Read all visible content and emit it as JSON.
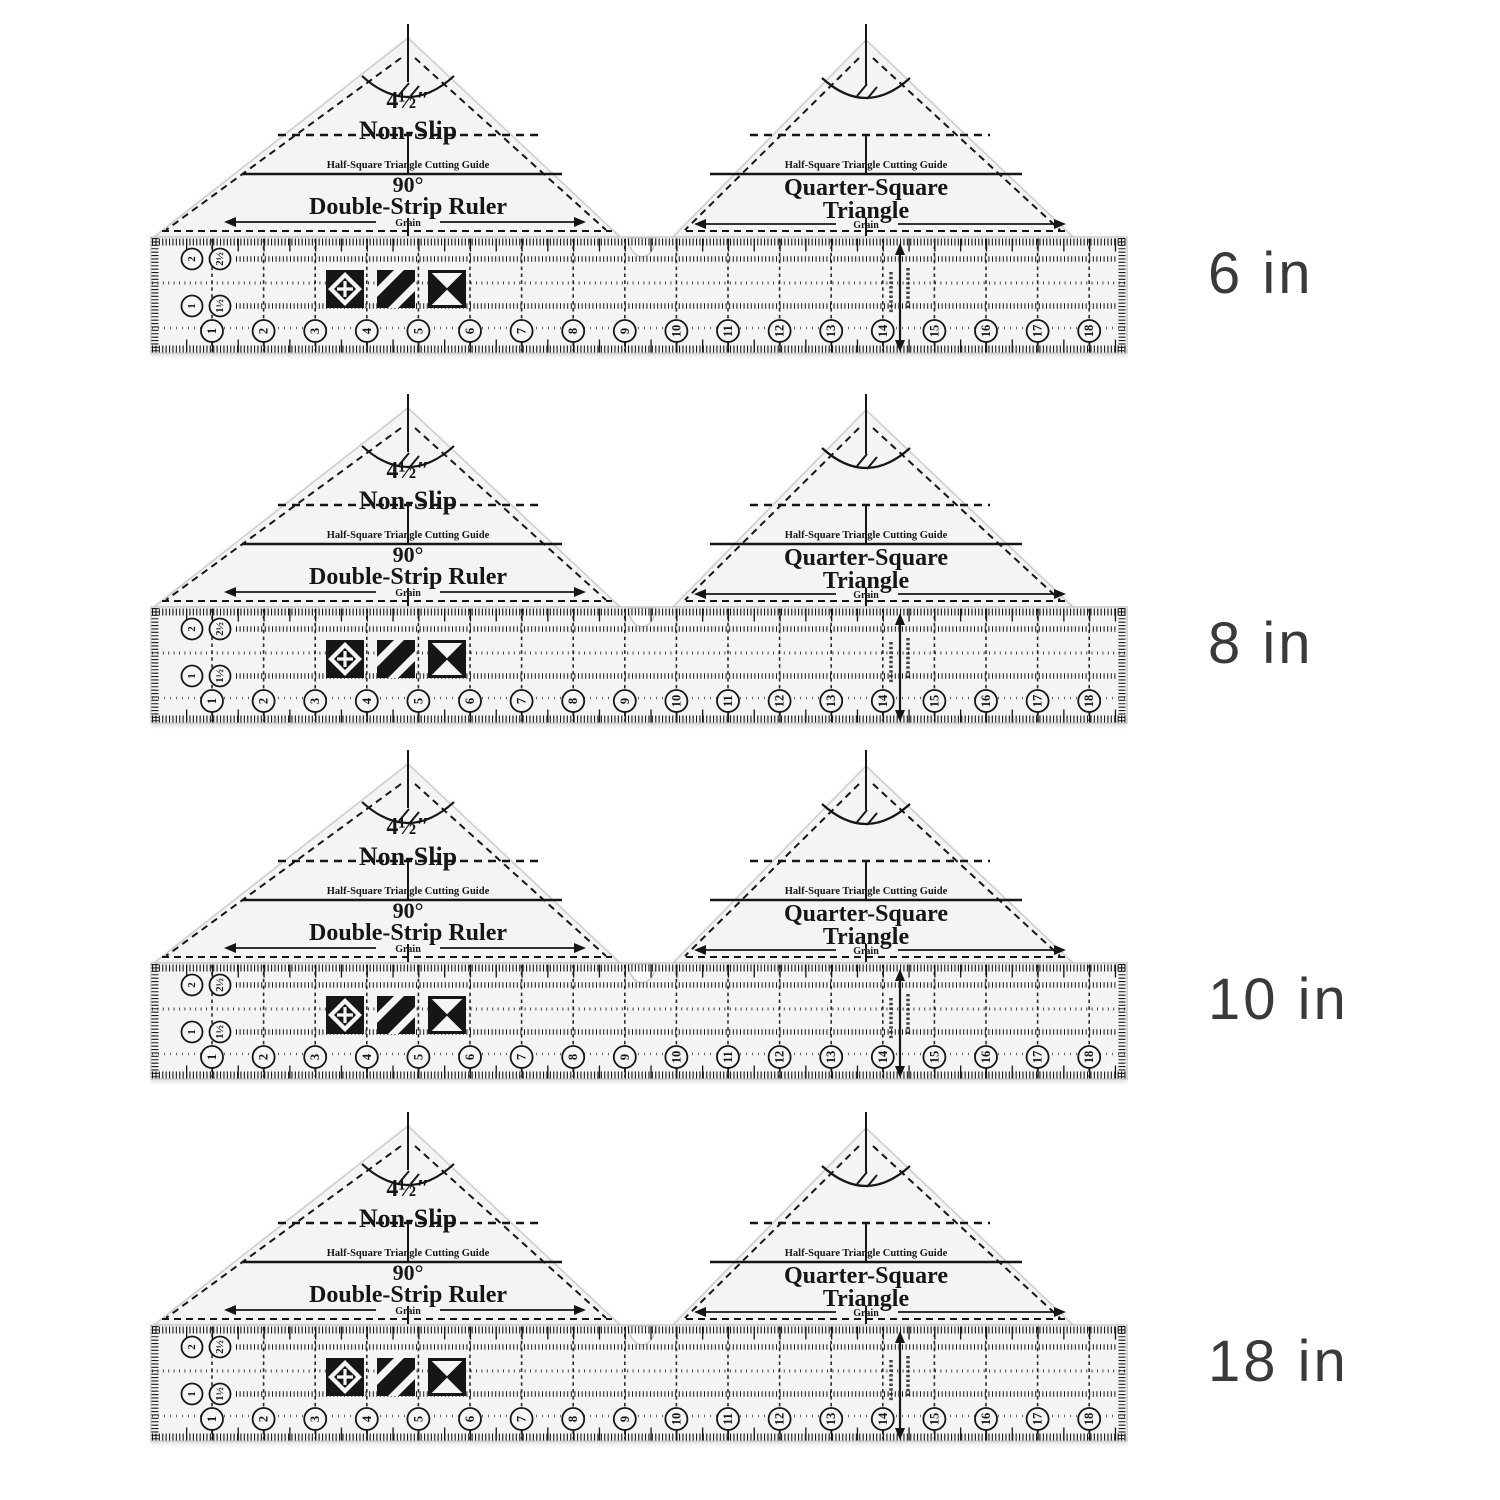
{
  "page": {
    "background": "#ffffff",
    "description_labels_unit": "in"
  },
  "rows": [
    {
      "size_label": "6 in"
    },
    {
      "size_label": "8 in"
    },
    {
      "size_label": "10 in"
    },
    {
      "size_label": "18 in"
    }
  ],
  "ruler": {
    "left_triangle": {
      "size": "4½″",
      "nonslip": "Non-Slip",
      "cutting_guide": "Half-Square Triangle Cutting Guide",
      "angle": "90°",
      "title": "Double-Strip Ruler",
      "grain": "Grain"
    },
    "right_triangle": {
      "cutting_guide": "Half-Square Triangle Cutting Guide",
      "title_line1": "Quarter-Square",
      "title_line2": "Triangle",
      "grain": "Grain"
    },
    "scale": {
      "inch_numbers": [
        "1",
        "2",
        "3",
        "4",
        "5",
        "6",
        "7",
        "8",
        "9",
        "10",
        "11",
        "12",
        "13",
        "14",
        "15",
        "16",
        "17",
        "18"
      ],
      "strip_width_labels": [
        "2",
        "2½",
        "1",
        "1½"
      ]
    },
    "block_icons": [
      "square-in-square",
      "diagonal-stripes",
      "hourglass"
    ],
    "colors": {
      "acrylic_body": "#f4f4f4",
      "print": "#161616",
      "size_label_text": "#3a3a3a",
      "background": "#ffffff"
    }
  }
}
